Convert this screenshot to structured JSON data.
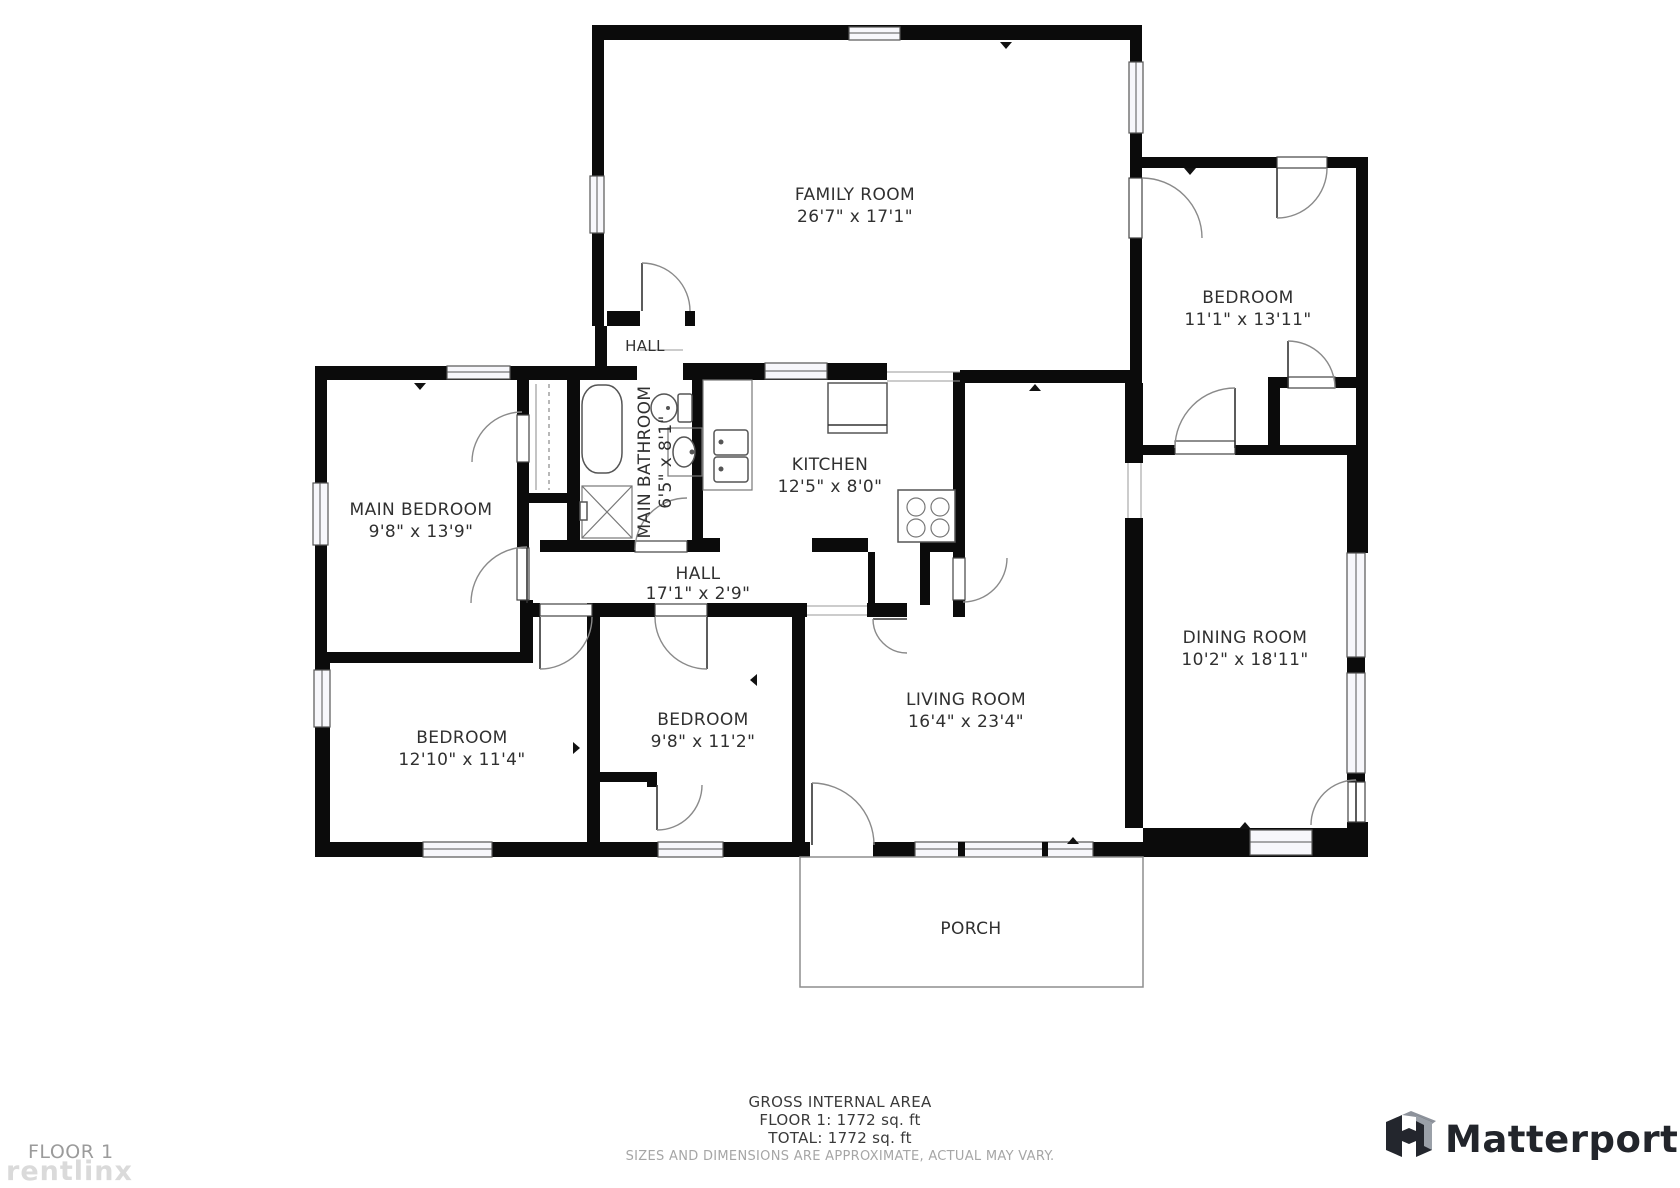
{
  "rooms": {
    "family": {
      "name": "FAMILY ROOM",
      "dims": "26'7\" x 17'1\""
    },
    "bedroom_tr": {
      "name": "BEDROOM",
      "dims": "11'1\" x 13'11\""
    },
    "hall_upper": {
      "name": "HALL"
    },
    "bathroom": {
      "name": "MAIN BATHROOM",
      "dims": "6'5\" x 8'1\""
    },
    "kitchen": {
      "name": "KITCHEN",
      "dims": "12'5\" x 8'0\""
    },
    "main_bedroom": {
      "name": "MAIN BEDROOM",
      "dims": "9'8\" x 13'9\""
    },
    "hall": {
      "name": "HALL",
      "dims": "17'1\" x 2'9\""
    },
    "dining": {
      "name": "DINING ROOM",
      "dims": "10'2\" x 18'11\""
    },
    "living": {
      "name": "LIVING ROOM",
      "dims": "16'4\" x 23'4\""
    },
    "bedroom_mid": {
      "name": "BEDROOM",
      "dims": "9'8\" x 11'2\""
    },
    "bedroom_left": {
      "name": "BEDROOM",
      "dims": "12'10\" x 11'4\""
    },
    "porch": {
      "name": "PORCH"
    }
  },
  "footer": {
    "gross_label": "GROSS INTERNAL AREA",
    "floor_line": "FLOOR 1: 1772 sq. ft",
    "total_line": "TOTAL: 1772 sq. ft",
    "disclaimer": "SIZES AND DIMENSIONS ARE APPROXIMATE, ACTUAL MAY VARY."
  },
  "page": {
    "floor_label": "FLOOR 1",
    "watermark": "rentlinx"
  },
  "branding": {
    "name": "Matterport"
  },
  "colors": {
    "wall": "#0b0b0b",
    "door_arc": "#8a8a8a",
    "text": "#303030",
    "muted": "#a6a6a6",
    "brand": "#22252b"
  }
}
